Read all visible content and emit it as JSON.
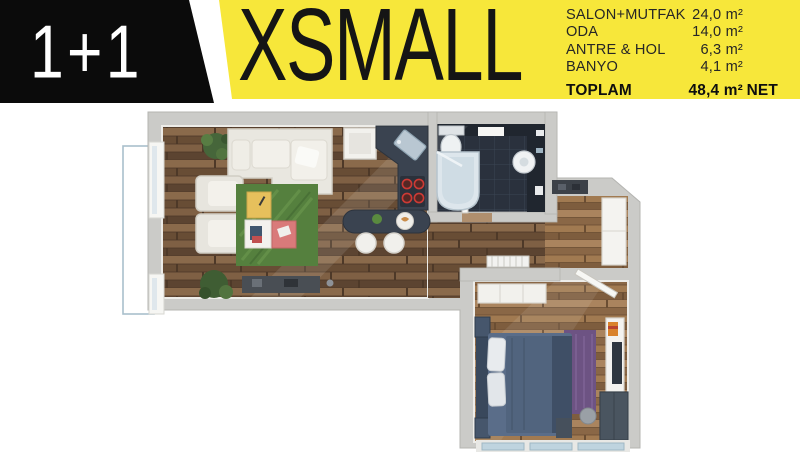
{
  "header": {
    "unit_type": "1+1",
    "plan_name": "XSMALL",
    "rooms": [
      {
        "label": "SALON+MUTFAK",
        "value": "24,0 m²"
      },
      {
        "label": "ODA",
        "value": "14,0 m²"
      },
      {
        "label": "ANTRE & HOL",
        "value": "6,3 m²"
      },
      {
        "label": "BANYO",
        "value": "4,1 m²"
      }
    ],
    "total": {
      "label": "TOPLAM",
      "value": "48,4 m²",
      "suffix": "NET"
    }
  },
  "colors": {
    "banner_yellow": "#F7E73A",
    "header_black": "#0B0B0B",
    "text_dark": "#1A1A1A",
    "wall_gray": "#CBCBC8",
    "wood_dark": "#7A5D43",
    "wood_light": "#A07A57",
    "bath_tile": "#2A313D",
    "kitchen_dark": "#3A4350",
    "burner_red": "#C93A35",
    "rug_green": "#57823F",
    "bed_navy": "#51647E",
    "rug_purple": "#6D5383",
    "balcony_line": "#A9C0CC"
  }
}
